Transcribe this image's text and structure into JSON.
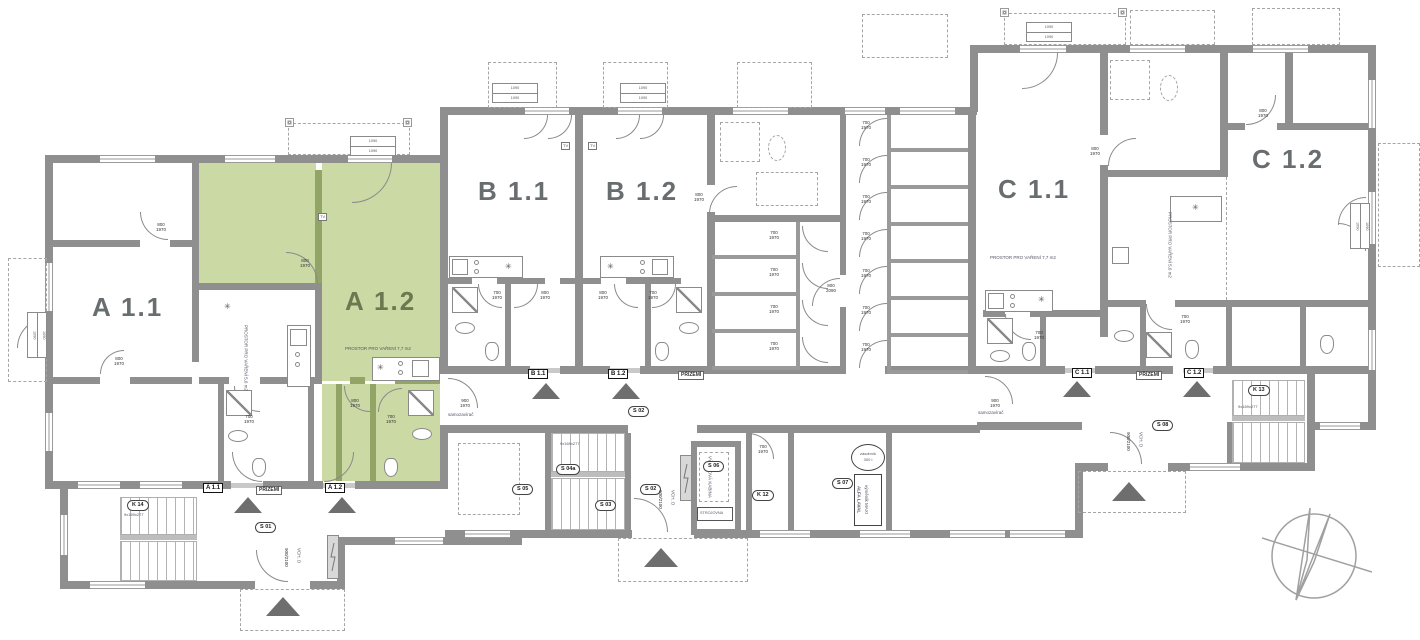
{
  "units": {
    "a11": {
      "label": "A 1.1",
      "tag": "A 1.1"
    },
    "a12": {
      "label": "A 1.2",
      "tag": "A 1.2"
    },
    "b11": {
      "label": "B 1.1",
      "tag": "B 1.1"
    },
    "b12": {
      "label": "B 1.2",
      "tag": "B 1.2"
    },
    "c11": {
      "label": "C 1.1",
      "tag": "C 1.1"
    },
    "c12": {
      "label": "C 1.2",
      "tag": "C 1.2"
    }
  },
  "floor_tag": "PŘÍZEMÍ",
  "rooms": {
    "s01": "S 01",
    "s02": "S 02",
    "s03": "S 03",
    "s04a": "S 04a",
    "s05": "S 05",
    "s06": "S 06",
    "s07": "S 07",
    "s08": "S 08",
    "k12": "K 12",
    "k13": "K 13",
    "k14": "K 14"
  },
  "annotations": {
    "cooking_77": "PROSTOR PRO VAŘENÍ 7,7 m2",
    "cooking_56": "PROSTOR PRO VAŘENÍ 5,6 m2",
    "elevator_cabin": "VÝTAHOVÁ KABINA",
    "machine_room": "STROJOVNA",
    "exchanger1": "ALFA LAVAL",
    "exchanger2": "výměník MAXI",
    "tank1": "zásobník",
    "tank2": "300 l",
    "self_closer": "samozavírač",
    "entry_door": "VCH. D",
    "tv": "TV",
    "stair_spec": "9x169x277",
    "window_tag": "1090",
    "stove_symbol": "✳"
  },
  "dims": {
    "d700": {
      "w": "700",
      "h": "1970"
    },
    "d800": {
      "w": "800",
      "h": "1970"
    },
    "d900": {
      "w": "900",
      "h": "1970"
    },
    "d800h": {
      "w": "800",
      "h": "2090"
    },
    "d900e": {
      "w": "900",
      "h": "2100"
    }
  },
  "colors": {
    "highlight": "#cbd9a4",
    "wall": "#8f8f8f"
  }
}
